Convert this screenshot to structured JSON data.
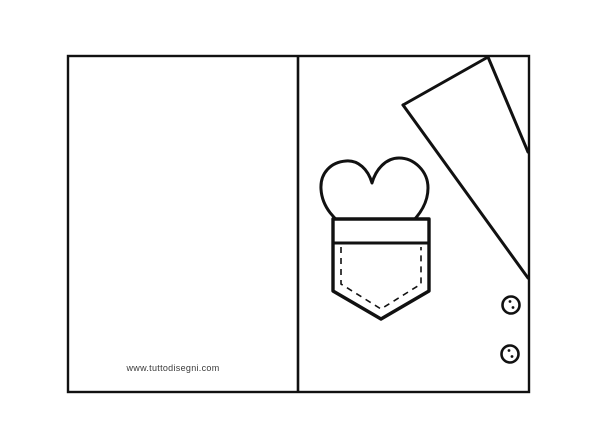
{
  "page": {
    "background_color": "#ffffff",
    "line_color": "#111111"
  },
  "watermark": {
    "text": "www.tuttodisegni.com",
    "color": "#3a3a3a"
  },
  "illustration": {
    "kind": "foldable greeting card template (shirt with heart pocket)",
    "left_panel": "blank",
    "right_panel_elements": [
      "collar-flap",
      "heart",
      "pocket-with-stitching",
      "buttons"
    ],
    "button_count": 2
  }
}
